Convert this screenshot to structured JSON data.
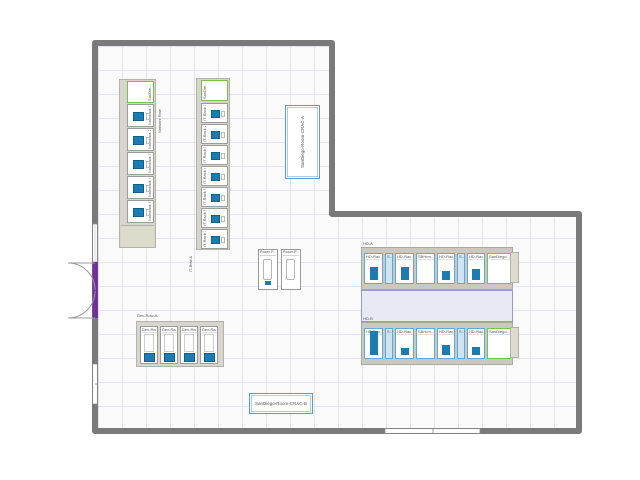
{
  "floorplan": {
    "rows": {
      "network": {
        "label": "Network Row",
        "top_rack_label": "SanDie...",
        "racks": [
          "Net-Rack 1",
          "Net-Rack 2",
          "Net-Rack 3",
          "Net-Rack 4",
          "Net-Rack 5"
        ]
      },
      "it": {
        "label": "IT-Row A",
        "top_rack_label": "SanDie...",
        "racks": [
          "IT-Rack 1",
          "IT-Rack 2",
          "IT-Rack 3",
          "IT-Rack 4",
          "IT-Rack 5",
          "IT-Rack 6",
          "IT-Rack 7"
        ]
      },
      "hd_a": {
        "label": "HD-A",
        "racks": [
          {
            "label": "HD-Rac...",
            "kind": "hd",
            "bar_h": 13
          },
          {
            "label": "S...",
            "kind": "narrow"
          },
          {
            "label": "HD-Rac...",
            "kind": "hd",
            "bar_h": 13
          },
          {
            "label": "SBHrm...",
            "kind": "chassis"
          },
          {
            "label": "HD-Rac...",
            "kind": "hd",
            "bar_h": 9
          },
          {
            "label": "S...",
            "kind": "narrow"
          },
          {
            "label": "HD-Rac...",
            "kind": "hd",
            "bar_h": 11
          },
          {
            "label": "SanDiego...",
            "kind": "green"
          }
        ]
      },
      "hd_b": {
        "label": "HD-B",
        "racks": [
          {
            "label": "HD-Rac...",
            "kind": "hd",
            "bar_h": 24
          },
          {
            "label": "S...",
            "kind": "narrow"
          },
          {
            "label": "HD-Rac...",
            "kind": "hd",
            "bar_h": 7
          },
          {
            "label": "SBHrm...",
            "kind": "chassis"
          },
          {
            "label": "HD-Rac...",
            "kind": "hd",
            "bar_h": 10
          },
          {
            "label": "S...",
            "kind": "narrow"
          },
          {
            "label": "HD-Rac...",
            "kind": "hd",
            "bar_h": 8
          },
          {
            "label": "SanDiego...",
            "kind": "green"
          }
        ]
      },
      "dev": {
        "label": "Dev-Row-A",
        "racks": [
          "Dev-Ra...",
          "Dev-Ra...",
          "Dev-Ra...",
          "Dev-Ra..."
        ]
      }
    },
    "cracs": {
      "a": "SanDiego-Room-CRAC-A",
      "b": "SanDiego-Room-CRAC-B"
    },
    "power_panels": [
      "Power-P...",
      "Power-P..."
    ],
    "colors": {
      "wall": "#7a7a7a",
      "floor": "#fafafb",
      "grid_line": "#e4e4ec",
      "rack_blue": "#1a7cb0",
      "hd_border": "#5fa8d8",
      "green_border": "#7cc143",
      "crac_border": "#5b9bd5",
      "aisle_fill": "#e9e9f3",
      "aisle_border": "#9a9ac9",
      "door_purple": "#7030a0",
      "endcap_tan": "#dcdccd"
    }
  }
}
